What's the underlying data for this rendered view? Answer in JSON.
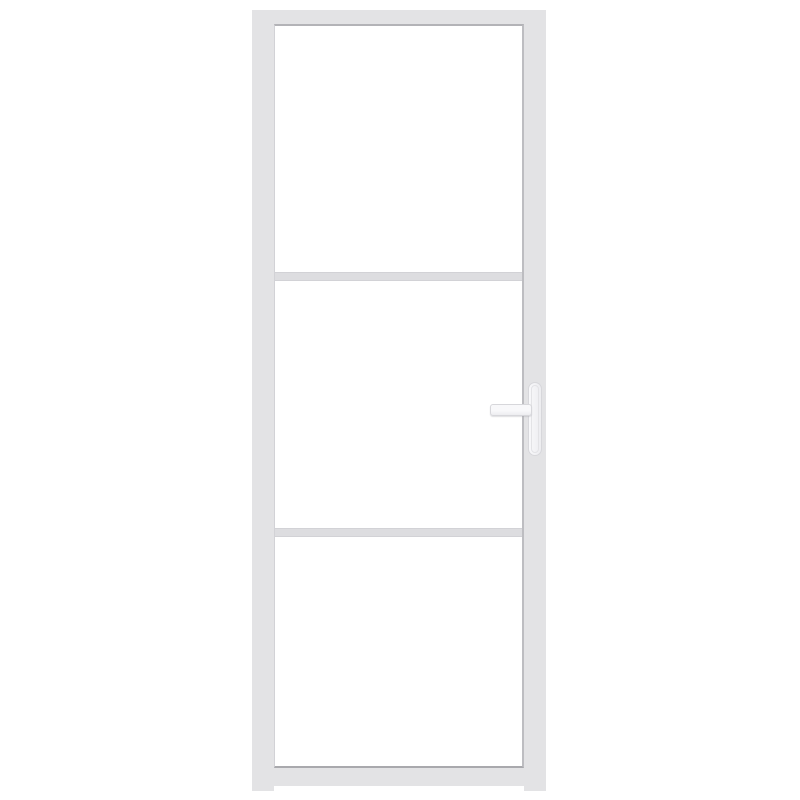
{
  "scene": {
    "type": "product-photo",
    "subject": "White interior door with slim frame, three glass panes divided by two horizontal glazing bars, and a lever handle on a backplate on the right side",
    "background_style": "plain white studio background"
  },
  "door": {
    "pane_count": 3,
    "divider_count": 2,
    "handle_side": "right",
    "handle_type": "lever-on-backplate",
    "feet_count": 2
  },
  "colors": {
    "background": "#ffffff",
    "frame": "#e3e3e5",
    "frame-edge-top": "#b3b3b7",
    "frame-edge-bottom": "#a9a9ad",
    "frame-edge-left": "#d2d2d6",
    "frame-edge-right": "#bdbdc1",
    "glass": "#ffffff",
    "divider": "#dddde0",
    "divider-edge": "#d2d2d6",
    "handle-fill": "#f8f8fa",
    "handle-shade": "#ededf0",
    "handle-outline": "#d7d7db",
    "handle-inner-line": "#e3e3e6"
  }
}
